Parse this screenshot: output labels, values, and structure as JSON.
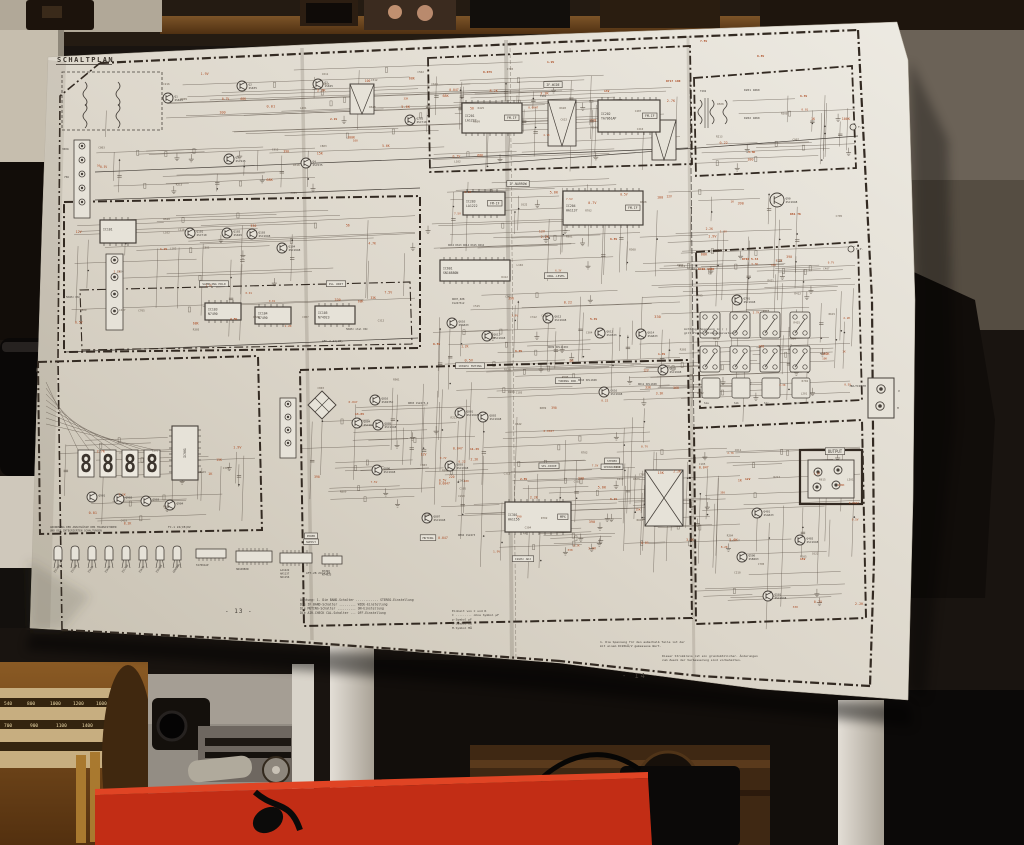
{
  "poster": {
    "title": "SCHALTPLAN",
    "page_left": "- 13 -",
    "page_right": "- 14 -",
    "display_digits": [
      "8",
      "8",
      "8",
      "8"
    ],
    "ics": [
      {
        "ref": "IC201",
        "part": "LA1222",
        "tag": "FM-IF",
        "x": 462,
        "y": 103,
        "w": 60,
        "h": 30
      },
      {
        "ref": "IC202",
        "part": "TA7061AP",
        "tag": "FM-IF",
        "x": 598,
        "y": 100,
        "w": 62,
        "h": 32
      },
      {
        "ref": "IC203",
        "part": "LA1222",
        "tag": "FM-IF",
        "x": 463,
        "y": 192,
        "w": 42,
        "h": 23
      },
      {
        "ref": "IC204",
        "part": "HA1137",
        "tag": "FM-IF",
        "x": 563,
        "y": 191,
        "w": 80,
        "h": 34
      },
      {
        "ref": "IC601",
        "part": "SN16880N",
        "tag": "",
        "x": 440,
        "y": 260,
        "w": 70,
        "h": 21
      },
      {
        "ref": "IC301",
        "part": "HA1156",
        "tag": "MPX",
        "x": 505,
        "y": 502,
        "w": 66,
        "h": 30
      },
      {
        "ref": "IC101",
        "part": "",
        "tag": "",
        "x": 100,
        "y": 220,
        "w": 36,
        "h": 23
      },
      {
        "ref": "IC103",
        "part": "N7490",
        "tag": "",
        "x": 205,
        "y": 303,
        "w": 36,
        "h": 17
      },
      {
        "ref": "IC104",
        "part": "N7490",
        "tag": "",
        "x": 255,
        "y": 307,
        "w": 36,
        "h": 17
      },
      {
        "ref": "IC105",
        "part": "N74923",
        "tag": "",
        "x": 315,
        "y": 306,
        "w": 40,
        "h": 18
      }
    ],
    "ic_vertical": {
      "ref": "IC901",
      "x": 172,
      "y": 426,
      "w": 26,
      "h": 54
    },
    "transistors": [
      {
        "lab": "Q1 2SK49",
        "x": 168,
        "y": 98
      },
      {
        "lab": "Q2 2SK35",
        "x": 242,
        "y": 86
      },
      {
        "lab": "Q3 1SK45",
        "x": 318,
        "y": 84
      },
      {
        "lab": "Q4 2SC535",
        "x": 306,
        "y": 163
      },
      {
        "lab": "Q5 2SC945",
        "x": 229,
        "y": 159
      },
      {
        "lab": "Q101 2SC710",
        "x": 190,
        "y": 233
      },
      {
        "lab": "Q102 2SK49",
        "x": 227,
        "y": 233
      },
      {
        "lab": "Q103 2SC1648",
        "x": 252,
        "y": 234
      },
      {
        "lab": "Q104 2SC1648",
        "x": 282,
        "y": 248
      },
      {
        "lab": "Q202 2SC710",
        "x": 410,
        "y": 120
      },
      {
        "lab": "Q90 2SC1648",
        "x": 777,
        "y": 200,
        "r": 7
      },
      {
        "lab": "Q701 2SC1648",
        "x": 737,
        "y": 300
      },
      {
        "lab": "Q610 2SA823",
        "x": 452,
        "y": 323
      },
      {
        "lab": "Q611 2SC1648",
        "x": 487,
        "y": 336
      },
      {
        "lab": "Q612 2SC1648",
        "x": 548,
        "y": 318
      },
      {
        "lab": "Q613 2SC823",
        "x": 600,
        "y": 333
      },
      {
        "lab": "Q614 2SA823",
        "x": 641,
        "y": 334
      },
      {
        "lab": "Q615 2SC1648",
        "x": 663,
        "y": 370
      },
      {
        "lab": "Q616 2SC1648",
        "x": 604,
        "y": 392
      },
      {
        "lab": "Q801 2SC1648",
        "x": 460,
        "y": 413
      },
      {
        "lab": "Q802 2SC1648",
        "x": 483,
        "y": 417
      },
      {
        "lab": "Q810 2SD235C",
        "x": 375,
        "y": 400
      },
      {
        "lab": "Q804 2SC1648",
        "x": 357,
        "y": 423
      },
      {
        "lab": "Q805 2SC1648",
        "x": 378,
        "y": 425
      },
      {
        "lab": "Q806 2SC1648",
        "x": 377,
        "y": 470
      },
      {
        "lab": "Q803 2SC1648",
        "x": 450,
        "y": 466
      },
      {
        "lab": "Q807 2SC1648",
        "x": 427,
        "y": 518
      },
      {
        "lab": "Q401 2SA823",
        "x": 757,
        "y": 513
      },
      {
        "lab": "Q402 2SC1648",
        "x": 800,
        "y": 540
      },
      {
        "lab": "Q500 2SB463",
        "x": 742,
        "y": 557
      },
      {
        "lab": "Q501 2SC1648",
        "x": 768,
        "y": 596
      },
      {
        "lab": "Q901",
        "x": 92,
        "y": 497
      },
      {
        "lab": "Q902",
        "x": 119,
        "y": 499
      },
      {
        "lab": "Q903",
        "x": 146,
        "y": 501
      },
      {
        "lab": "Q904",
        "x": 170,
        "y": 505
      }
    ],
    "boxed_labels": [
      {
        "t": "IF-WIDE",
        "x": 553,
        "y": 86,
        "s": 3.2
      },
      {
        "t": "IF-NARROW",
        "x": 518,
        "y": 185,
        "s": 3.2
      },
      {
        "t": "SAMPLING HOLD",
        "x": 214,
        "y": 285,
        "s": 3
      },
      {
        "t": "PLL UNIT",
        "x": 336,
        "y": 285,
        "s": 3
      },
      {
        "t": "100kHz MUTING",
        "x": 470,
        "y": 367,
        "s": 3
      },
      {
        "t": "TUNING IND.",
        "x": 568,
        "y": 382,
        "s": 3
      },
      {
        "t": "UNGL.LEVEL",
        "x": 556,
        "y": 277,
        "s": 3
      },
      {
        "t": "STEREO",
        "x": 612,
        "y": 462,
        "s": 2.8
      },
      {
        "t": "SEPARATION",
        "x": 612,
        "y": 468,
        "s": 2.8
      },
      {
        "t": "SEL.DIODE",
        "x": 549,
        "y": 467,
        "s": 2.8
      },
      {
        "t": "MUTING",
        "x": 428,
        "y": 539,
        "s": 3
      },
      {
        "t": "POWER",
        "x": 311,
        "y": 537,
        "s": 2.8
      },
      {
        "t": "SUPPLY",
        "x": 311,
        "y": 543,
        "s": 2.8
      },
      {
        "t": "19kHz ADJ",
        "x": 523,
        "y": 560,
        "s": 3
      },
      {
        "t": "OUTPUT",
        "x": 835,
        "y": 453,
        "s": 4
      }
    ],
    "plain_labels": [
      {
        "t": "MULTIPATH",
        "x": 866,
        "y": 387,
        "s": 3,
        "a": "end"
      },
      {
        "t": "V",
        "x": 898,
        "y": 392,
        "s": 3
      },
      {
        "t": "H",
        "x": 897,
        "y": 409,
        "s": 3
      },
      {
        "t": "T.P.",
        "x": 858,
        "y": 128,
        "s": 3
      },
      {
        "t": "T.P.",
        "x": 856,
        "y": 250,
        "s": 3
      },
      {
        "t": "D201 1N60",
        "x": 744,
        "y": 91,
        "s": 2.9
      },
      {
        "t": "D202 1N60",
        "x": 744,
        "y": 119,
        "s": 2.9
      },
      {
        "t": "D607,608",
        "x": 452,
        "y": 300,
        "s": 2.6
      },
      {
        "t": "1S2473x2",
        "x": 452,
        "y": 304,
        "s": 2.6
      },
      {
        "t": "D609 SEL1C40C",
        "x": 548,
        "y": 348,
        "s": 2.6
      },
      {
        "t": "D610 SEL1048",
        "x": 578,
        "y": 381,
        "s": 2.6
      },
      {
        "t": "D611 SEL1048",
        "x": 638,
        "y": 385,
        "s": 2.6
      },
      {
        "t": "D803 1S2473-2",
        "x": 408,
        "y": 404,
        "s": 2.6
      },
      {
        "t": "D804 1S2473",
        "x": 458,
        "y": 536,
        "s": 2.6
      },
      {
        "t": "D612 D613 D614 D615 D616",
        "x": 448,
        "y": 246,
        "s": 2.5
      },
      {
        "t": "AFC-2 24(CB)",
        "x": 322,
        "y": 342,
        "s": 2.9
      },
      {
        "t": "50kHz xtal OSC",
        "x": 346,
        "y": 330,
        "s": 2.6
      },
      {
        "t": "50kHz OSC",
        "x": 66,
        "y": 298,
        "s": 2.6
      },
      {
        "t": "AFT-28 24(A)03",
        "x": 306,
        "y": 574,
        "s": 2.9
      },
      {
        "t": "FC-1 24(CB)02",
        "x": 168,
        "y": 528,
        "s": 2.9
      },
      {
        "t": "FIX VARIABLE",
        "x": 812,
        "y": 466,
        "s": 2.6
      },
      {
        "t": "300Ω",
        "x": 62,
        "y": 150,
        "s": 2.7
      },
      {
        "t": "75Ω",
        "x": 64,
        "y": 178,
        "s": 2.7
      },
      {
        "t": "T201",
        "x": 540,
        "y": 97,
        "s": 2.6
      },
      {
        "t": "T202",
        "x": 700,
        "y": 92,
        "s": 2.6
      }
    ],
    "switch_labels": [
      "S1a",
      "S1b",
      "S1c",
      "S1d"
    ],
    "notes": [
      {
        "x": 300,
        "y": 601,
        "s": 3.1,
        "lh": 4.3,
        "lines": [
          "Achtung: 1. Die BAND-Schalter ............ STEREO-Einstellung",
          "            Die IF BAND-Schalter ......... WIDE-Einstellung",
          "            Die MUTING-Schalter .......... ON-Einstellung",
          "            Die AIR-CHECK CAL-Schalter ... OFF-Einstellung"
        ]
      },
      {
        "x": 452,
        "y": 612,
        "s": 3,
        "lh": 4.2,
        "lines": [
          "Einheit von C und R",
          "C ......... ohne Symbol µF",
          "p-Symbol  pF",
          "K-Symbol  kΩ",
          "M-Symbol  MΩ"
        ]
      },
      {
        "x": 600,
        "y": 643,
        "s": 3,
        "lh": 4.2,
        "lines": [
          "1. Die Spannung für den außerhalb Teile ist der",
          "   mit einem DC20kΩ/V gemessene Wert."
        ]
      },
      {
        "x": 662,
        "y": 657,
        "s": 3,
        "lh": 4.2,
        "lines": [
          "Dieser Stromkreis ist ein grundsätzlicher.  Änderungen",
          "zum Zweck der Verbesserung sind vorbehalten."
        ]
      },
      {
        "x": 684,
        "y": 330,
        "s": 3,
        "lh": 4.2,
        "lines": [
          "Achtung: Spannung in ( )",
          "gilt für Verstimmungszustand"
        ]
      }
    ],
    "legend": {
      "caption_lines": [
        "ANORDNUNG DER ANSCHLÜSSE DER TRANSISTOREN",
        "UND DER INTEGRIERTEN SCHALTUNGEN"
      ],
      "packages": [
        "2SC458",
        "2SC945",
        "2SK19",
        "2SK49",
        "2SC710",
        "2SK35",
        "2SD235",
        "GENERAL"
      ],
      "ic_packages": [
        {
          "label": "TA7061AP"
        },
        {
          "label": "SN16880N"
        },
        {
          "label": "LA1222 HA1137 HA1156"
        },
        {
          "label": "N7490 N74923"
        }
      ]
    },
    "ann_fixed": [
      {
        "t": "7.5V",
        "x": 700,
        "y": 42
      },
      {
        "t": "0.8V",
        "x": 757,
        "y": 57
      },
      {
        "t": "6.3V",
        "x": 800,
        "y": 97
      },
      {
        "t": "3.3K",
        "x": 748,
        "y": 153
      },
      {
        "t": "R717 100",
        "x": 666,
        "y": 82
      },
      {
        "t": "13V",
        "x": 604,
        "y": 92
      },
      {
        "t": "1.9V",
        "x": 547,
        "y": 63
      },
      {
        "t": "0.07V",
        "x": 483,
        "y": 73
      },
      {
        "t": "R81 7K",
        "x": 790,
        "y": 215
      },
      {
        "t": "R704 5.34",
        "x": 742,
        "y": 260
      },
      {
        "t": "R706 390K",
        "x": 698,
        "y": 270
      },
      {
        "t": "0.5V",
        "x": 433,
        "y": 345
      },
      {
        "t": "6.0V",
        "x": 515,
        "y": 352
      },
      {
        "t": "5.4V",
        "x": 590,
        "y": 320
      },
      {
        "t": "1.4V",
        "x": 658,
        "y": 355
      },
      {
        "t": "11.4V",
        "x": 470,
        "y": 450
      },
      {
        "t": "2.8V",
        "x": 520,
        "y": 480
      },
      {
        "t": "6.1V",
        "x": 610,
        "y": 500
      },
      {
        "t": "12V",
        "x": 745,
        "y": 480
      },
      {
        "t": "15V",
        "x": 800,
        "y": 560
      },
      {
        "t": "13.8V",
        "x": 355,
        "y": 415
      },
      {
        "t": "4.5V",
        "x": 230,
        "y": 320
      },
      {
        "t": "1.2V",
        "x": 160,
        "y": 250
      },
      {
        "t": "2.1V",
        "x": 330,
        "y": 120
      },
      {
        "t": "6.8V",
        "x": 610,
        "y": 240
      }
    ],
    "annotation_values": [
      "0.01",
      "0.047",
      "4.7K",
      "10K",
      "47K",
      "100",
      "330",
      "2.2K",
      "1K",
      "560",
      "68K",
      "6.3V",
      "0.7V",
      "1.9V",
      "12V",
      "5.6K",
      "220",
      "3.3K",
      "0.5V",
      "7.5V",
      "15K",
      "8.2K",
      "0.22",
      "1.2K",
      "390",
      "100K",
      "33K",
      "0.0047",
      "2.7K",
      "56"
    ],
    "ref_values": [
      "R101",
      "C105",
      "R204",
      "C210",
      "L201",
      "R305",
      "C304",
      "R412",
      "C407",
      "R508",
      "C502",
      "R615",
      "C611",
      "R702",
      "C705",
      "R809",
      "C803",
      "R901",
      "C907",
      "L102",
      "R213",
      "C216",
      "R318",
      "C312",
      "R425",
      "C419",
      "R520",
      "C515",
      "R628",
      "C622"
    ]
  },
  "room": {
    "dial_rows": [
      [
        "540",
        "800",
        "1000",
        "1200",
        "1600"
      ],
      [
        "700",
        "900",
        "1100",
        "1400"
      ]
    ]
  }
}
